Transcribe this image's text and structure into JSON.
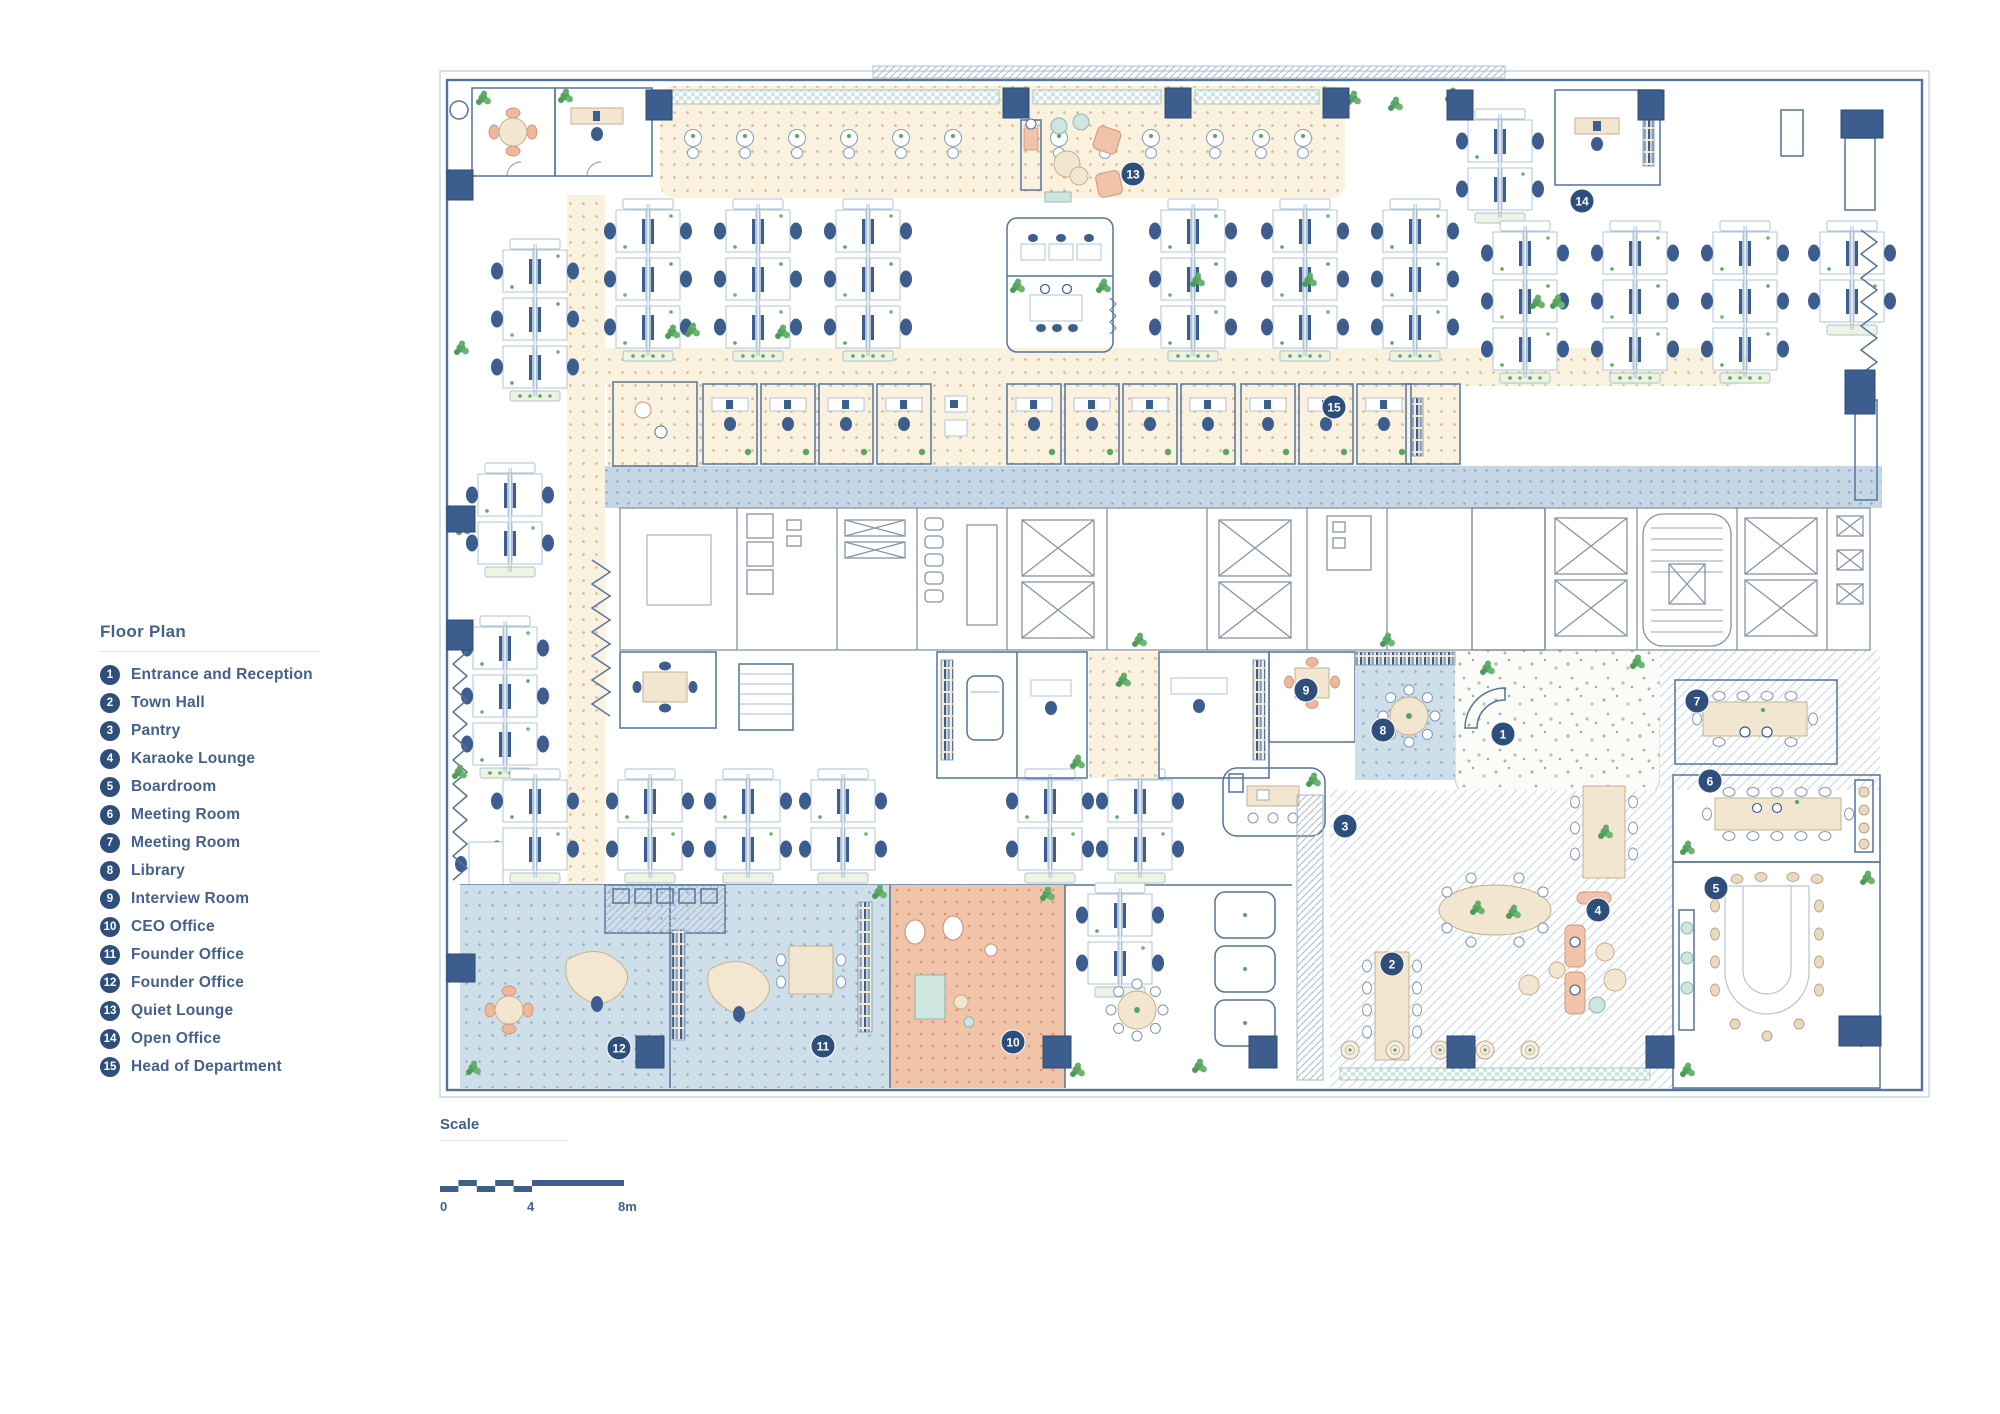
{
  "legend": {
    "title": "Floor Plan",
    "items": [
      {
        "n": "1",
        "label": "Entrance and Reception"
      },
      {
        "n": "2",
        "label": "Town Hall"
      },
      {
        "n": "3",
        "label": "Pantry"
      },
      {
        "n": "4",
        "label": "Karaoke Lounge"
      },
      {
        "n": "5",
        "label": "Boardroom"
      },
      {
        "n": "6",
        "label": "Meeting Room"
      },
      {
        "n": "7",
        "label": "Meeting Room"
      },
      {
        "n": "8",
        "label": "Library"
      },
      {
        "n": "9",
        "label": "Interview Room"
      },
      {
        "n": "10",
        "label": "CEO Office"
      },
      {
        "n": "11",
        "label": "Founder Office"
      },
      {
        "n": "12",
        "label": "Founder Office"
      },
      {
        "n": "13",
        "label": "Quiet Lounge"
      },
      {
        "n": "14",
        "label": "Open Office"
      },
      {
        "n": "15",
        "label": "Head of Department"
      }
    ]
  },
  "scale": {
    "title": "Scale",
    "ticks": [
      "0",
      "4",
      "8m"
    ]
  },
  "markers": [
    {
      "n": "1",
      "label": "Entrance and Reception",
      "x": 1056,
      "y": 654
    },
    {
      "n": "2",
      "label": "Town Hall",
      "x": 945,
      "y": 884
    },
    {
      "n": "3",
      "label": "Pantry",
      "x": 898,
      "y": 746
    },
    {
      "n": "4",
      "label": "Karaoke Lounge",
      "x": 1151,
      "y": 830
    },
    {
      "n": "5",
      "label": "Boardroom",
      "x": 1269,
      "y": 808
    },
    {
      "n": "6",
      "label": "Meeting Room",
      "x": 1263,
      "y": 701
    },
    {
      "n": "7",
      "label": "Meeting Room",
      "x": 1250,
      "y": 621
    },
    {
      "n": "8",
      "label": "Library",
      "x": 936,
      "y": 650
    },
    {
      "n": "9",
      "label": "Interview Room",
      "x": 859,
      "y": 610
    },
    {
      "n": "10",
      "label": "CEO Office",
      "x": 566,
      "y": 962
    },
    {
      "n": "11",
      "label": "Founder Office",
      "x": 376,
      "y": 966
    },
    {
      "n": "12",
      "label": "Founder Office",
      "x": 172,
      "y": 968
    },
    {
      "n": "13",
      "label": "Quiet Lounge",
      "x": 686,
      "y": 94
    },
    {
      "n": "14",
      "label": "Open Office",
      "x": 1135,
      "y": 121
    },
    {
      "n": "15",
      "label": "Head of Department",
      "x": 887,
      "y": 327
    }
  ],
  "colors": {
    "navy": "#2e4e7c",
    "ink": "#44608c",
    "wall": "#54749e",
    "wallgray": "#8593a6",
    "green": "#57a85c"
  }
}
